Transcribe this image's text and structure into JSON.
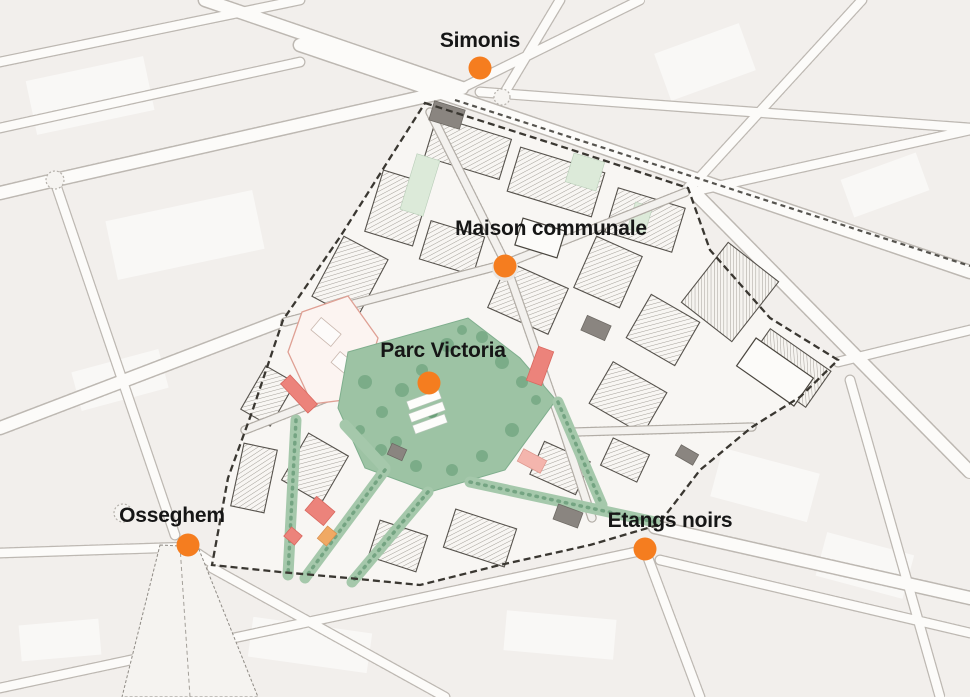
{
  "markers": [
    {
      "id": "simonis",
      "label": "Simonis",
      "dot": {
        "x": 480,
        "y": 68
      },
      "text": {
        "x": 480,
        "y": 41
      }
    },
    {
      "id": "maison-communale",
      "label": "Maison communale",
      "dot": {
        "x": 505,
        "y": 266
      },
      "text": {
        "x": 551,
        "y": 229
      }
    },
    {
      "id": "parc-victoria",
      "label": "Parc Victoria",
      "dot": {
        "x": 429,
        "y": 383
      },
      "text": {
        "x": 443,
        "y": 351
      }
    },
    {
      "id": "osseghem",
      "label": "Osseghem",
      "dot": {
        "x": 188,
        "y": 545
      },
      "text": {
        "x": 172,
        "y": 516
      }
    },
    {
      "id": "etangs-noirs",
      "label": "Etangs noirs",
      "dot": {
        "x": 645,
        "y": 549
      },
      "text": {
        "x": 670,
        "y": 521
      }
    }
  ],
  "style": {
    "marker_color": "#F57D1F",
    "label_color": "#161616",
    "background": "#F2EFEC",
    "district_fill": "#F8F6F3",
    "boundary_color": "#3A3731",
    "park_green": "#9DC3A4",
    "corridor_green": "#A5C8AB",
    "tree_green": "#6FA07D",
    "accent_red": "#EC837B",
    "accent_salmon": "#F4B5AD",
    "accent_orange": "#F0A964",
    "building_gray": "#8A8580"
  }
}
